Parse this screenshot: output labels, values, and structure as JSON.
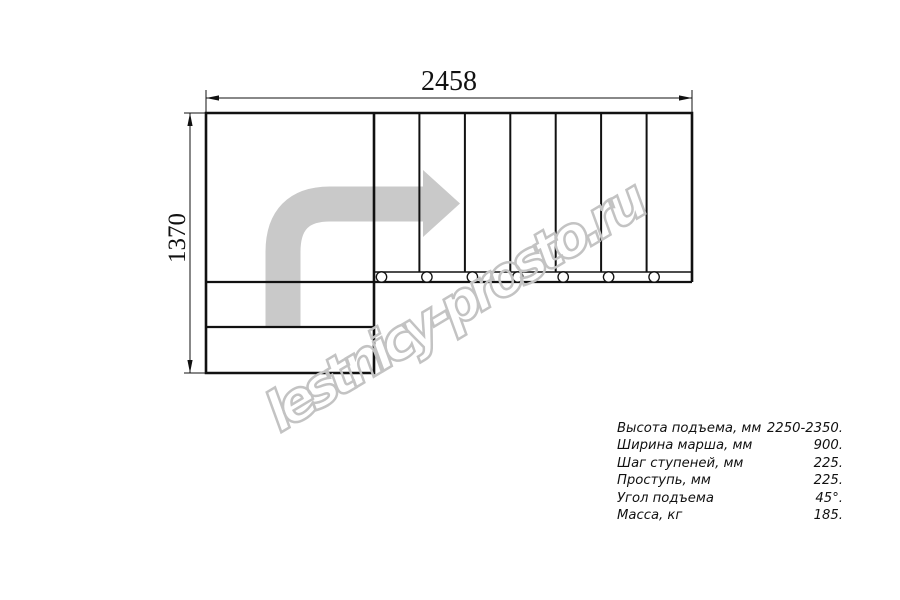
{
  "title": "Stair plan drawing",
  "dimensions": {
    "width_label": "2458",
    "height_label": "1370"
  },
  "plan": {
    "tread_count": 7,
    "tread_post_count": 7
  },
  "watermark": {
    "text": "lestnicy-prosto.ru"
  },
  "specs": {
    "rows": [
      {
        "label": "Высота подъема, мм",
        "value": "2250-2350."
      },
      {
        "label": "Ширина марша, мм",
        "value": "900."
      },
      {
        "label": "Шаг ступеней, мм",
        "value": "225."
      },
      {
        "label": "Проступь, мм",
        "value": "225."
      },
      {
        "label": "Угол подъема",
        "value": "45°."
      },
      {
        "label": "Масса, кг",
        "value": "185."
      }
    ]
  },
  "colors": {
    "line": "#111111",
    "direction_arrow": "#c9c9c9",
    "watermark": "#c3c3c3",
    "background": "#ffffff"
  }
}
